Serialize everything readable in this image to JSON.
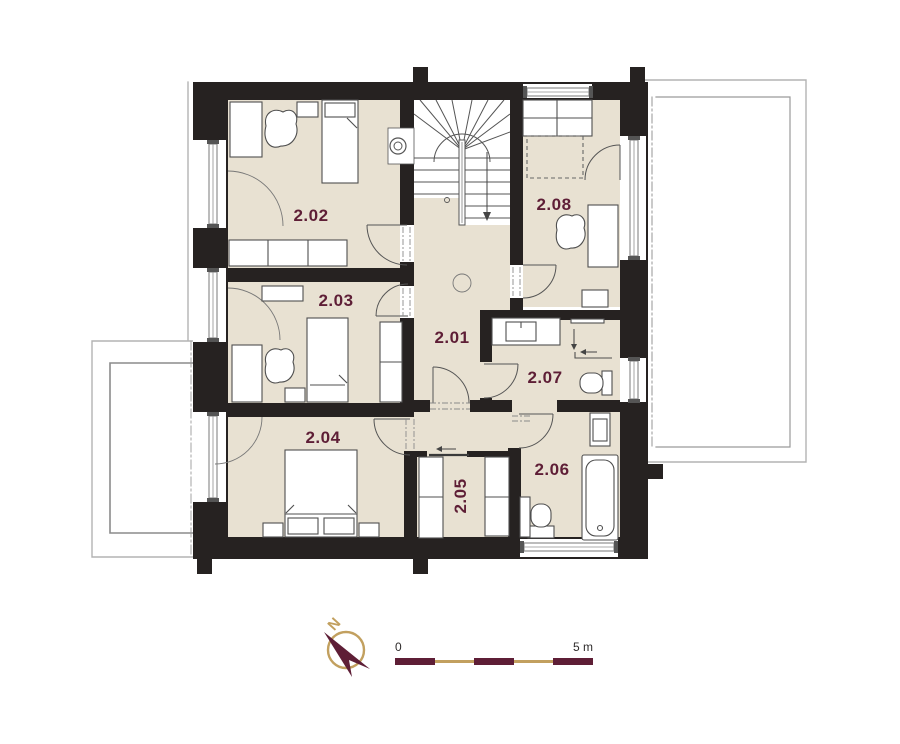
{
  "floor_plan": {
    "rooms": [
      {
        "id": "room-2-01",
        "label": "2.01"
      },
      {
        "id": "room-2-02",
        "label": "2.02"
      },
      {
        "id": "room-2-03",
        "label": "2.03"
      },
      {
        "id": "room-2-04",
        "label": "2.04"
      },
      {
        "id": "room-2-05",
        "label": "2.05"
      },
      {
        "id": "room-2-06",
        "label": "2.06"
      },
      {
        "id": "room-2-07",
        "label": "2.07"
      },
      {
        "id": "room-2-08",
        "label": "2.08"
      }
    ],
    "compass": {
      "north_label": "N"
    },
    "scale_bar": {
      "start_label": "0",
      "end_label": "5 m"
    },
    "colors": {
      "wall": "#262221",
      "floor": "#e8e1d2",
      "accent_maroon": "#5e1e36",
      "accent_tan": "#c2a05f",
      "outline_gray": "#555555",
      "window_gray": "#8f8f8f"
    },
    "icons": [
      "north-arrow-icon",
      "stairs-icon",
      "bed-icon",
      "double-bed-icon",
      "armchair-icon",
      "wardrobe-icon",
      "desk-icon",
      "sofa-bed-icon",
      "bathtub-icon",
      "toilet-icon",
      "sink-icon",
      "shower-arrow-icon",
      "door-swing-icon",
      "window-icon",
      "duct-icon"
    ]
  }
}
